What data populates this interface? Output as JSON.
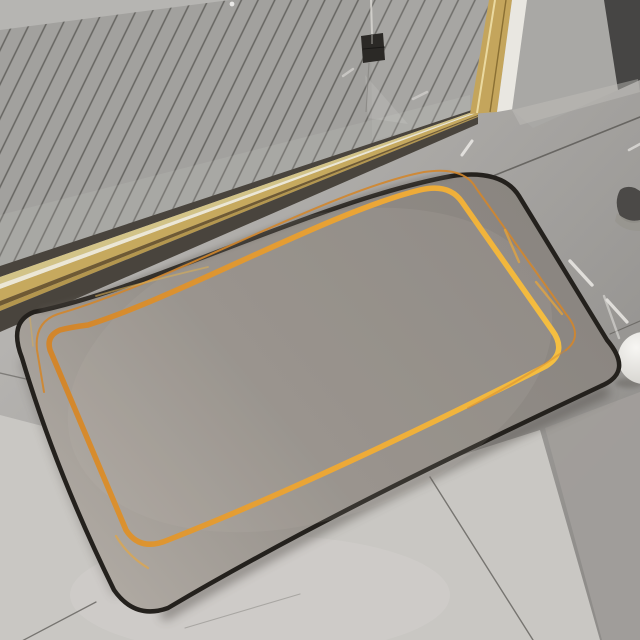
{
  "scene": {
    "alt": "Photo of a rectangular beige bath mat with a black edge and hand-drawn double gold line border, lying on gray tile floor in front of a shower with a gray slatted drain floor, brass threshold strip and gold-framed glass door; gray walls at top right, small white ball and dark object at right edge, white streak marks on the tiles."
  },
  "colors": {
    "floor_base": "#b5b3b0",
    "floor_far": "#8f8d8a",
    "tile_light": "#c9c7c3",
    "tile_lighter": "#d6d4d0",
    "tile_shadow": "#a29f9b",
    "grout": "#54524e",
    "dash": "#eceae6",
    "slat_base": "#a2a19e",
    "slat_line": "#5f5e5a",
    "slat_far_band": "#b6b5b2",
    "wall_light": "#a9a8a5",
    "wall_dark": "#464544",
    "frame_white": "#e9e7e1",
    "frame_gold": "#c4a55c",
    "frame_gold_light": "#ead9a0",
    "frame_gold_dark": "#8a6f33",
    "threshold_dark": "#49443d",
    "threshold_pale": "#d2c387",
    "threshold_white": "#ece7d5",
    "threshold_gold": "#c6a95e",
    "threshold_gold2": "#b3964e",
    "threshold_line": "#6f5a34",
    "mat_dark": "#8a8580",
    "mat_mid": "#948f89",
    "mat_light": "#b1aba4",
    "mat_edge": "#24211d",
    "gold_deep": "#d2862c",
    "gold_mid": "#eca736",
    "gold_bright": "#f6c242",
    "gold_pale": "#d9ae55",
    "glass_clamp": "#2b2926",
    "glass_line": "#d8d6d1",
    "obj_dark": "#4b4947",
    "obj_light": "#98968f",
    "ball_white": "#f7f6f3",
    "ball_shade": "#cfcdc8",
    "shadow": "#45403a"
  }
}
